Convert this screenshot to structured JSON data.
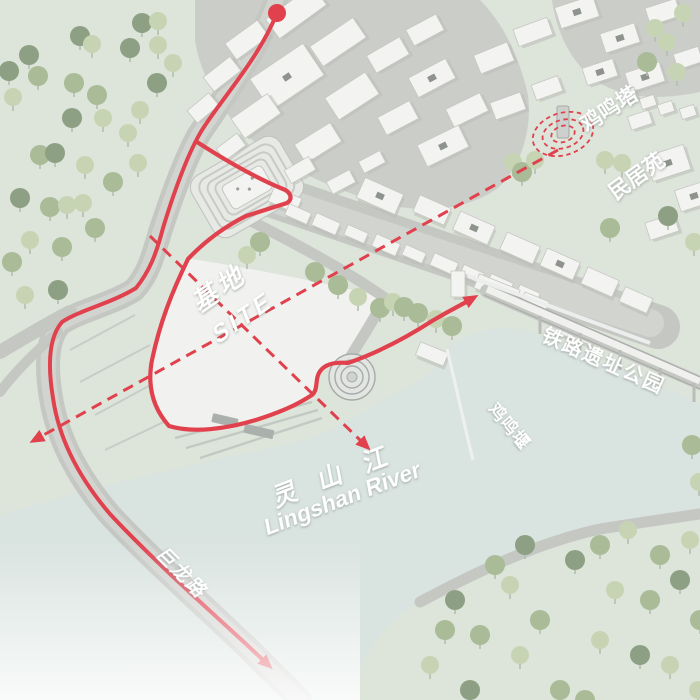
{
  "meta": {
    "title": "Axonometric site-analysis map, Lingshan River area",
    "view": "3D axonometric urban site plan with circulation route"
  },
  "colors": {
    "land": "#dde4da",
    "river": "#d9e3e0",
    "road": "#c5c7c3",
    "roadlite": "#d2d4d0",
    "ground_town": "#cbcdc9",
    "street": "#cfd1cd",
    "site_fill": "#f1f2ef",
    "building_fill": "#f3f3f1",
    "building_edge": "#c6c7c3",
    "building_shadow": "#b9bdb7",
    "tree_dark": "#8da083",
    "tree_mid": "#a9bb97",
    "tree_light": "#c7d4b4",
    "trunk": "#b3bfae",
    "red": "#e0414d",
    "label_white": "#ffffff"
  },
  "labels": {
    "pagoda": "鸡鸣塔",
    "folk_residence": "民居苑",
    "railway_park": "铁路遗址公园",
    "weir": "鸡鸣堰",
    "site_zh": "基地",
    "site_en": "SITE",
    "river_zh": "灵 山 江",
    "river_en": "Lingshan River",
    "road_name": "巨龙路"
  },
  "paths": {
    "ground_town": "M195,0 L480,0 C505,25 520,60 528,95 C532,130 522,165 498,188 C470,208 430,214 390,205 C340,193 290,170 252,140 C222,115 200,75 195,40 Z",
    "topright_ground": "M552,0 L700,0 L700,92 C660,100 625,100 595,80 C570,62 556,30 552,0 Z",
    "river": "M0,515 C35,505 70,495 100,487 C135,478 170,470 205,462 C245,452 280,447 312,438 C342,425 368,408 398,392 C423,380 438,370 452,342 C480,330 505,324 530,331 L700,403 L700,512 C635,515 567,526 503,556 C468,572 440,589 420,601 C392,618 365,645 348,700 L0,700 Z",
    "land_se": "M425,598 C480,570 540,540 600,528 C650,520 680,516 700,514 L700,700 L360,700 C372,660 395,625 425,598 Z",
    "site": "M186,258 C250,268 320,282 383,297 C374,322 362,342 348,362 C340,362 330,363 324,369 C317,376 321,388 314,395 C290,405 265,415 235,428 C210,434 185,433 168,427 C152,407 146,385 151,362 C160,322 172,288 186,258 Z",
    "road_main": "M276,0 C256,55 218,105 198,136 C184,162 172,196 160,232 C152,260 148,274 134,290 C110,305 78,311 60,324 C48,338 45,362 51,398 C58,441 80,480 110,515 C150,558 200,602 250,650 L300,700",
    "road_branch1": "M70,312 C45,325 20,340 0,352",
    "road_branch2": "M58,332 C35,352 15,372 0,392",
    "street_strip": "M262,192 L658,327",
    "street_lite": "M266,196 L650,323",
    "road_ne": "M247,219 C300,246 345,270 385,298 C373,322 359,342 348,361",
    "road_se": "M420,602 C480,570 540,542 600,529 C650,521 680,517 700,514",
    "rail_embank": "M487,291 L700,383",
    "rail_deck": "M487,289 L700,381",
    "rail_e1": "M484,295 L700,389",
    "rail_e2": "M490,285 L700,377",
    "rail_wall": "M468,276 L650,343",
    "weir_line": "M447,349 C457,390 463,420 473,460",
    "route_main": "M277,13 C258,60 222,98 202,130 C188,153 174,192 163,228 C156,255 149,272 136,288 C112,303 80,310 62,322 C50,336 47,362 53,398 C59,440 80,479 110,514 C150,557 198,600 246,644 L264,661",
    "route_loop": "M197,142 C228,162 256,178 283,189 C291,192 293,199 287,203 L246,216 C226,226 206,240 188,259 C172,292 160,322 152,360 C147,386 153,408 169,426 C192,433 226,430 262,418 C289,409 301,402 312,395 C319,389 314,378 321,370 C327,363 337,362 348,363 C371,355 401,341 432,321 C452,309 461,305 468,301",
    "axis_a": "M558,150 L40,437",
    "axis_b": "M150,236 L362,442",
    "terrace1": "M70,350 L135,315",
    "terrace2": "M80,382 L150,345",
    "terrace3": "M95,415 L160,380",
    "terrace4": "M105,450 L168,420",
    "bank1": "M175,438 L312,402",
    "bank2": "M186,448 L318,410",
    "bank3": "M200,458 L322,418"
  },
  "map": {
    "start_dot": {
      "x": 277,
      "y": 13,
      "r": 9
    },
    "pagoda": {
      "cx": 563,
      "cy": 134,
      "rings": [
        [
          12,
          8
        ],
        [
          21,
          14
        ],
        [
          31,
          21
        ]
      ],
      "tilt": -18
    },
    "trees": [
      [
        29,
        55,
        "d"
      ],
      [
        9,
        71,
        "d"
      ],
      [
        38,
        76,
        "m"
      ],
      [
        13,
        97,
        "l"
      ],
      [
        80,
        36,
        "d"
      ],
      [
        92,
        44,
        "l"
      ],
      [
        142,
        23,
        "d"
      ],
      [
        158,
        21,
        "l"
      ],
      [
        130,
        48,
        "d"
      ],
      [
        158,
        45,
        "l"
      ],
      [
        173,
        63,
        "l"
      ],
      [
        74,
        83,
        "m"
      ],
      [
        97,
        95,
        "m"
      ],
      [
        72,
        118,
        "d"
      ],
      [
        103,
        118,
        "l"
      ],
      [
        128,
        133,
        "l"
      ],
      [
        140,
        110,
        "l"
      ],
      [
        157,
        83,
        "d"
      ],
      [
        40,
        155,
        "m"
      ],
      [
        55,
        153,
        "d"
      ],
      [
        85,
        165,
        "l"
      ],
      [
        113,
        182,
        "m"
      ],
      [
        138,
        163,
        "l"
      ],
      [
        20,
        198,
        "d"
      ],
      [
        50,
        207,
        "m"
      ],
      [
        67,
        205,
        "l"
      ],
      [
        83,
        203,
        "l"
      ],
      [
        30,
        240,
        "l"
      ],
      [
        12,
        262,
        "m"
      ],
      [
        62,
        247,
        "m"
      ],
      [
        95,
        228,
        "m"
      ],
      [
        25,
        295,
        "l"
      ],
      [
        58,
        290,
        "d"
      ],
      [
        260,
        242,
        "m"
      ],
      [
        247,
        255,
        "l"
      ],
      [
        315,
        272,
        "m"
      ],
      [
        338,
        285,
        "m"
      ],
      [
        358,
        297,
        "l"
      ],
      [
        380,
        308,
        "m"
      ],
      [
        393,
        302,
        "l"
      ],
      [
        404,
        307,
        "m"
      ],
      [
        418,
        313,
        "m"
      ],
      [
        436,
        319,
        "l"
      ],
      [
        452,
        326,
        "m"
      ],
      [
        513,
        162,
        "l"
      ],
      [
        522,
        172,
        "m"
      ],
      [
        535,
        160,
        "l"
      ],
      [
        605,
        160,
        "l"
      ],
      [
        622,
        163,
        "l"
      ],
      [
        655,
        28,
        "l"
      ],
      [
        683,
        13,
        "l"
      ],
      [
        667,
        42,
        "l"
      ],
      [
        647,
        62,
        "m"
      ],
      [
        677,
        72,
        "l"
      ],
      [
        610,
        228,
        "m"
      ],
      [
        668,
        216,
        "d"
      ],
      [
        694,
        242,
        "l"
      ],
      [
        692,
        445,
        "m"
      ],
      [
        699,
        482,
        "l"
      ],
      [
        495,
        565,
        "m"
      ],
      [
        525,
        545,
        "d"
      ],
      [
        575,
        560,
        "d"
      ],
      [
        600,
        545,
        "m"
      ],
      [
        628,
        530,
        "l"
      ],
      [
        660,
        555,
        "m"
      ],
      [
        690,
        540,
        "l"
      ],
      [
        455,
        600,
        "d"
      ],
      [
        480,
        635,
        "m"
      ],
      [
        430,
        665,
        "l"
      ],
      [
        470,
        690,
        "d"
      ],
      [
        510,
        585,
        "l"
      ],
      [
        540,
        620,
        "m"
      ],
      [
        520,
        655,
        "l"
      ],
      [
        560,
        690,
        "m"
      ],
      [
        615,
        590,
        "l"
      ],
      [
        650,
        600,
        "m"
      ],
      [
        680,
        580,
        "d"
      ],
      [
        600,
        640,
        "l"
      ],
      [
        640,
        655,
        "d"
      ],
      [
        670,
        665,
        "l"
      ],
      [
        700,
        620,
        "m"
      ],
      [
        585,
        700,
        "m"
      ],
      [
        698,
        690,
        "l"
      ],
      [
        445,
        630,
        "m"
      ]
    ],
    "buildings": [
      [
        296,
        12,
        58,
        24,
        -36,
        0
      ],
      [
        247,
        40,
        40,
        20,
        -36,
        0
      ],
      [
        338,
        42,
        52,
        24,
        -34,
        0
      ],
      [
        222,
        74,
        34,
        18,
        -38,
        0
      ],
      [
        287,
        77,
        64,
        38,
        -34,
        1
      ],
      [
        352,
        96,
        48,
        26,
        -33,
        0
      ],
      [
        203,
        108,
        28,
        16,
        -40,
        0
      ],
      [
        256,
        116,
        44,
        24,
        -35,
        0
      ],
      [
        318,
        143,
        42,
        22,
        -32,
        0
      ],
      [
        231,
        147,
        26,
        15,
        -37,
        0
      ],
      [
        388,
        55,
        38,
        20,
        -30,
        0
      ],
      [
        425,
        30,
        34,
        18,
        -28,
        0
      ],
      [
        432,
        78,
        42,
        22,
        -28,
        1
      ],
      [
        467,
        110,
        38,
        20,
        -26,
        0
      ],
      [
        398,
        118,
        36,
        20,
        -28,
        0
      ],
      [
        443,
        146,
        46,
        24,
        -26,
        1
      ],
      [
        494,
        58,
        36,
        20,
        -22,
        0
      ],
      [
        533,
        32,
        36,
        18,
        -20,
        0
      ],
      [
        577,
        12,
        40,
        22,
        -18,
        1
      ],
      [
        620,
        38,
        36,
        20,
        -18,
        1
      ],
      [
        663,
        12,
        32,
        18,
        -18,
        0
      ],
      [
        600,
        72,
        32,
        18,
        -18,
        1
      ],
      [
        645,
        77,
        36,
        20,
        -18,
        1
      ],
      [
        688,
        58,
        26,
        16,
        -18,
        0
      ],
      [
        508,
        106,
        32,
        18,
        -20,
        0
      ],
      [
        547,
        88,
        28,
        16,
        -20,
        0
      ],
      [
        300,
        170,
        28,
        15,
        -30,
        0
      ],
      [
        341,
        182,
        26,
        14,
        -28,
        0
      ],
      [
        372,
        162,
        24,
        13,
        -28,
        0
      ],
      [
        668,
        163,
        40,
        26,
        -18,
        1
      ],
      [
        694,
        196,
        34,
        22,
        -18,
        1
      ],
      [
        662,
        227,
        30,
        18,
        -18,
        0
      ],
      [
        640,
        120,
        22,
        14,
        -18,
        0
      ],
      [
        628,
        95,
        16,
        12,
        -18,
        0
      ],
      [
        648,
        102,
        15,
        11,
        -18,
        0
      ],
      [
        666,
        108,
        15,
        11,
        -18,
        0
      ],
      [
        688,
        112,
        15,
        11,
        -18,
        0
      ],
      [
        380,
        196,
        42,
        22,
        24,
        1
      ],
      [
        432,
        210,
        34,
        18,
        24,
        0
      ],
      [
        474,
        228,
        38,
        20,
        24,
        1
      ],
      [
        520,
        248,
        36,
        19,
        24,
        0
      ],
      [
        560,
        264,
        36,
        19,
        24,
        1
      ],
      [
        600,
        282,
        34,
        18,
        24,
        0
      ],
      [
        636,
        300,
        30,
        16,
        24,
        0
      ],
      [
        285,
        200,
        30,
        16,
        24,
        0
      ],
      [
        298,
        214,
        24,
        12,
        24,
        0
      ],
      [
        326,
        224,
        26,
        13,
        24,
        0
      ],
      [
        356,
        234,
        22,
        11,
        24,
        0
      ],
      [
        386,
        245,
        26,
        13,
        24,
        0
      ],
      [
        414,
        254,
        22,
        11,
        24,
        0
      ],
      [
        444,
        264,
        26,
        13,
        24,
        0
      ],
      [
        472,
        274,
        22,
        11,
        24,
        0
      ],
      [
        500,
        284,
        24,
        12,
        24,
        0
      ],
      [
        528,
        294,
        22,
        11,
        24,
        0
      ],
      [
        497,
        289,
        44,
        15,
        22,
        0
      ],
      [
        535,
        302,
        26,
        11,
        22,
        0
      ],
      [
        458,
        284,
        14,
        26,
        0,
        0
      ],
      [
        432,
        354,
        30,
        14,
        22,
        0
      ],
      [
        565,
        332,
        18,
        7,
        23,
        0
      ],
      [
        586,
        340,
        14,
        6,
        23,
        0
      ]
    ]
  }
}
